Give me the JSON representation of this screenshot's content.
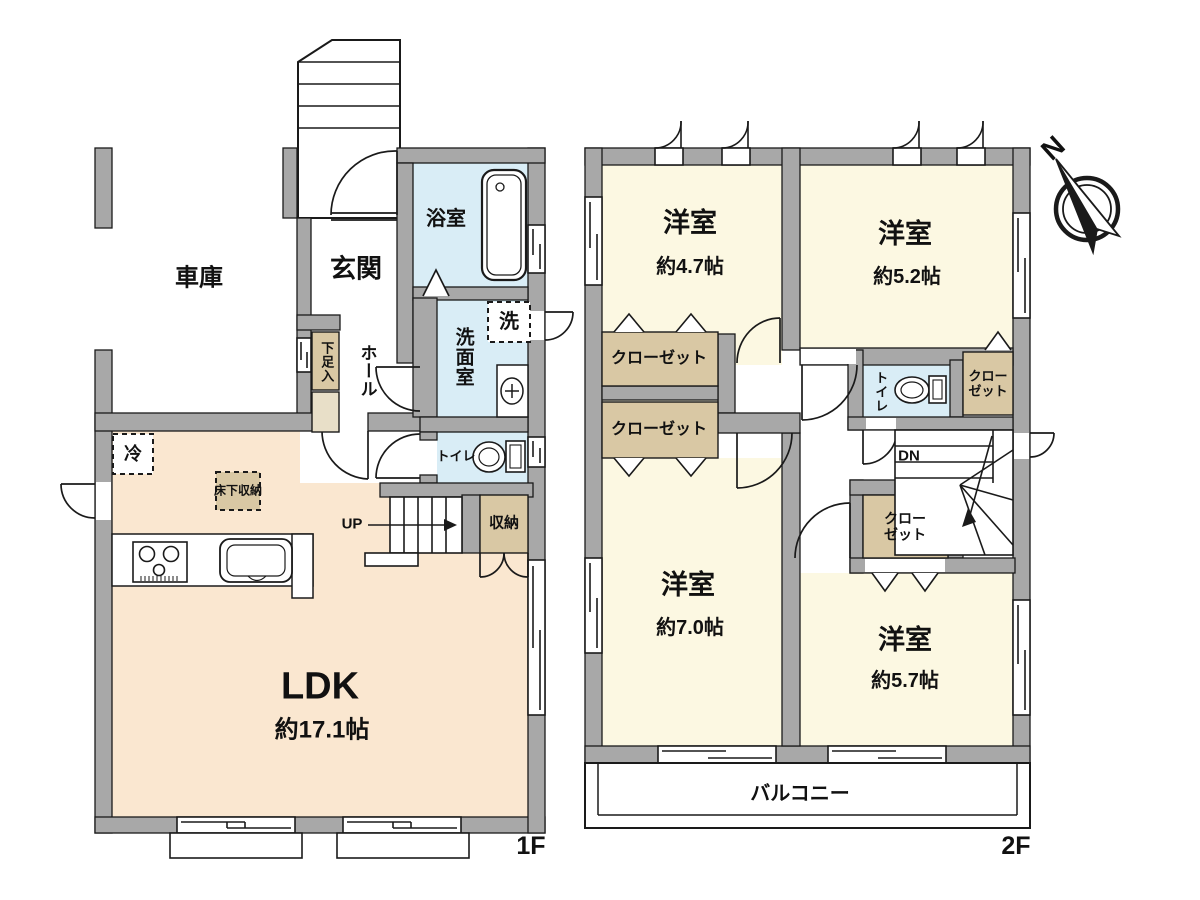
{
  "palette": {
    "wall_gray": "#a8a8a8",
    "ldk_floor": "#fae7d0",
    "room_floor": "#fcf8e2",
    "water_blue": "#d9edf6",
    "closet_tan": "#d9c8a4",
    "outline": "#1a1a1a"
  },
  "floor1": {
    "floor_label": "1F",
    "garage_label": "車庫",
    "entrance_label": "玄関",
    "bath_label": "浴室",
    "washer_label": "洗",
    "washroom_label": "洗面室",
    "shoe_storage_label": "下足入",
    "hall_label": "ホール",
    "toilet_label": "トイレ",
    "fridge_label": "冷",
    "underfloor_storage_label": "床下収納",
    "stairs_up_label": "UP",
    "storage_label": "収納",
    "ldk_label": "LDK",
    "ldk_size": "約17.1帖"
  },
  "floor2": {
    "floor_label": "2F",
    "rooms": [
      {
        "name": "洋室",
        "size": "約4.7帖"
      },
      {
        "name": "洋室",
        "size": "約5.2帖"
      },
      {
        "name": "洋室",
        "size": "約7.0帖"
      },
      {
        "name": "洋室",
        "size": "約5.7帖"
      }
    ],
    "closet_labels": [
      "クローゼット",
      "クローゼット",
      "クローゼット",
      "クローゼット"
    ],
    "toilet_label": "トイレ",
    "stairs_down_label": "DN",
    "balcony_label": "バルコニー"
  },
  "compass": {
    "north_label": "N"
  }
}
